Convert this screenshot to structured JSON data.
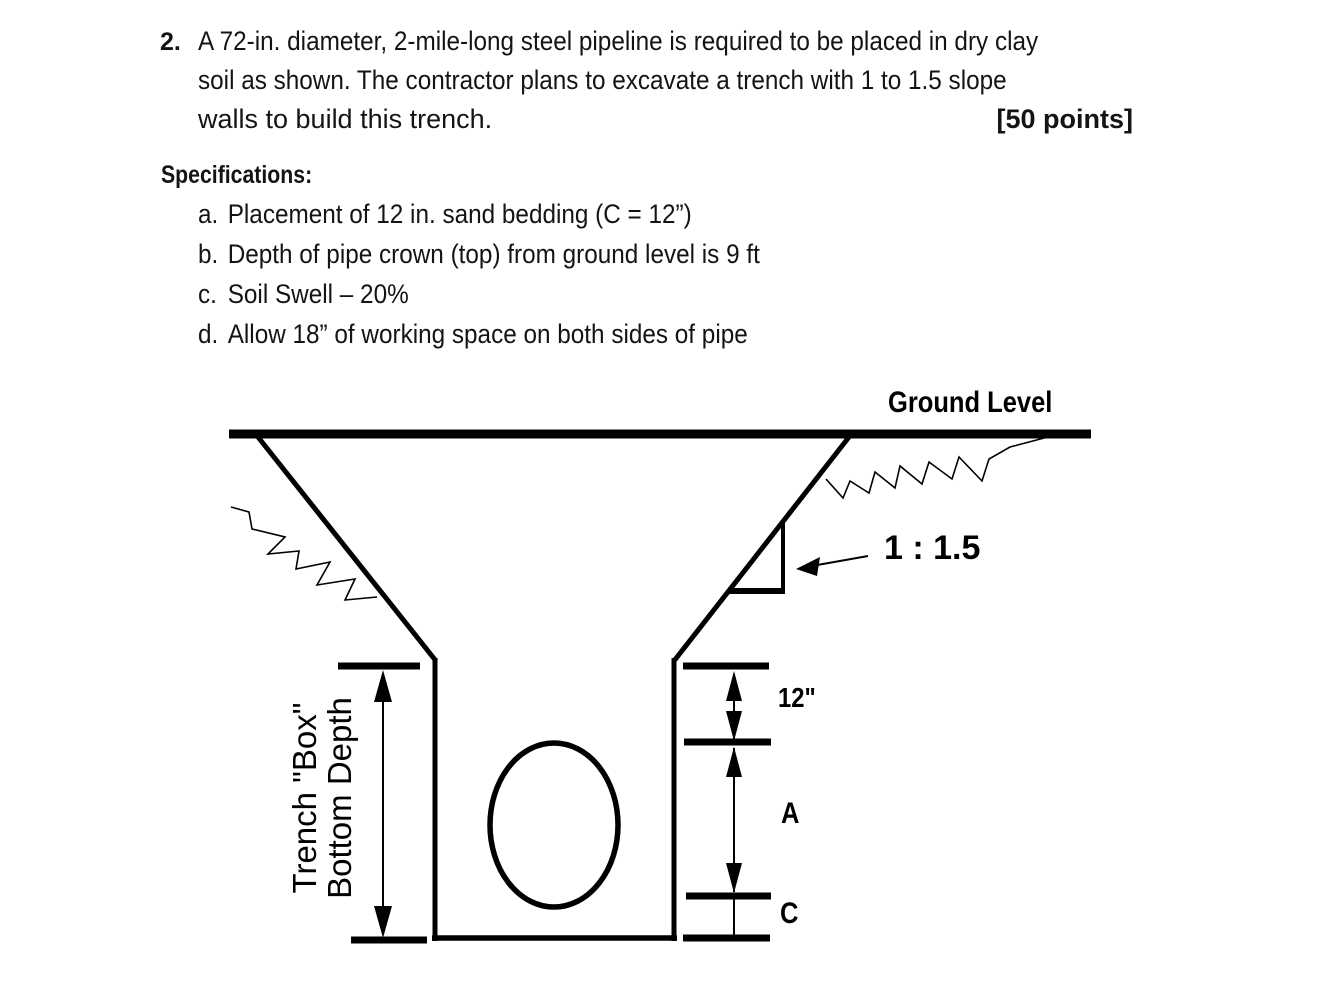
{
  "question": {
    "number": "2.",
    "lines": [
      "A 72-in. diameter, 2-mile-long steel pipeline is required to be placed in dry clay",
      "soil as shown. The contractor plans to excavate a trench with 1 to 1.5 slope",
      "walls to build this trench."
    ],
    "points": "[50 points]"
  },
  "specifications": {
    "heading": "Specifications:",
    "items": [
      {
        "marker": "a.",
        "text": "Placement of 12 in. sand bedding (C = 12”)"
      },
      {
        "marker": "b.",
        "text": "Depth of pipe crown (top) from ground level is 9 ft"
      },
      {
        "marker": "c.",
        "text": "Soil Swell – 20%"
      },
      {
        "marker": "d.",
        "text": "Allow 18” of working space on both sides of pipe"
      }
    ]
  },
  "diagram": {
    "ground_level_label": "Ground Level",
    "slope_ratio_label": "1 : 1.5",
    "bedding_dim_label": "12\"",
    "dim_a_label": "A",
    "dim_c_label": "C",
    "trench_depth_label_line1": "Trench \"Box\"",
    "trench_depth_label_line2": "Bottom Depth",
    "ink_color": "#000000",
    "background_color": "#ffffff"
  }
}
